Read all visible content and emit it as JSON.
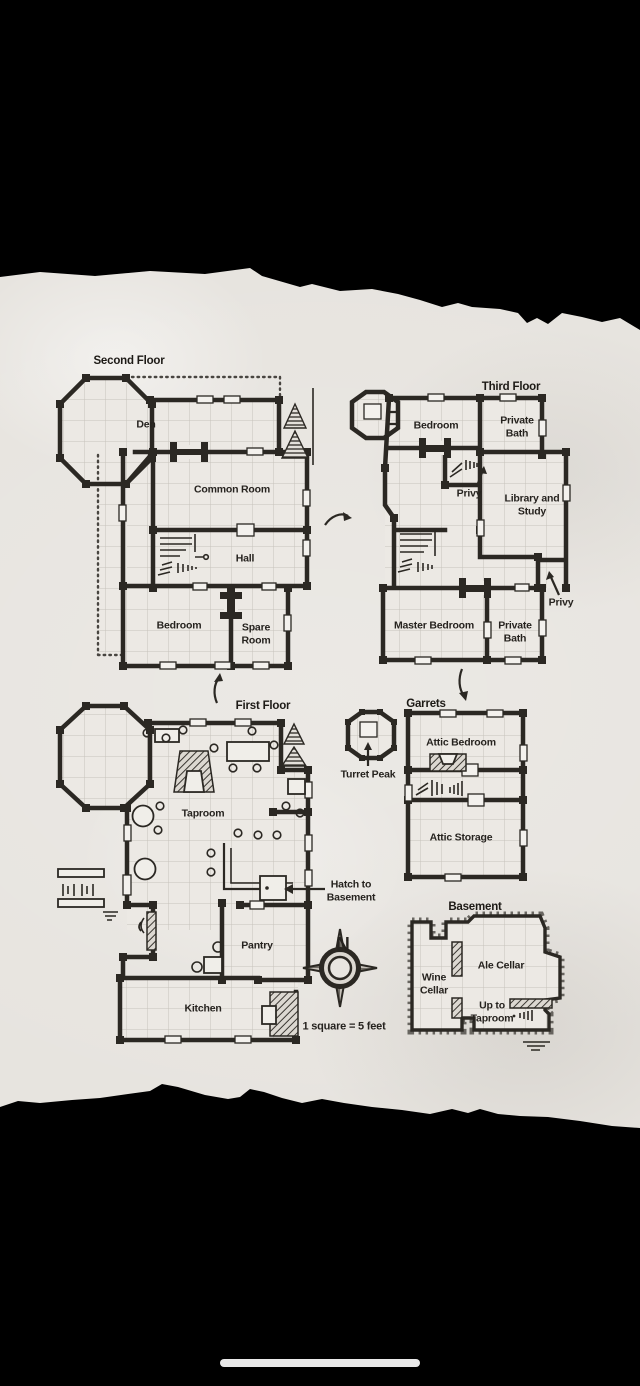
{
  "map": {
    "second_floor": {
      "title": "Second Floor",
      "rooms": {
        "den": "Den",
        "common_room": "Common Room",
        "hall": "Hall",
        "bedroom": "Bedroom",
        "spare_room": "Spare Room"
      }
    },
    "third_floor": {
      "title": "Third Floor",
      "rooms": {
        "bedroom": "Bedroom",
        "private_bath_top": "Private Bath",
        "privy_inner": "Privy",
        "library_study": "Library and Study",
        "privy_outer": "Privy",
        "master_bedroom": "Master Bedroom",
        "private_bath_bottom": "Private Bath"
      }
    },
    "first_floor": {
      "title": "First Floor",
      "rooms": {
        "taproom": "Taproom",
        "pantry": "Pantry",
        "kitchen": "Kitchen"
      },
      "hatch_note": "Hatch to Basement"
    },
    "turret_peak": {
      "label": "Turret Peak"
    },
    "garrets": {
      "title": "Garrets",
      "rooms": {
        "attic_bedroom": "Attic Bedroom",
        "attic_storage": "Attic Storage"
      }
    },
    "basement": {
      "title": "Basement",
      "rooms": {
        "wine_cellar": "Wine Cellar",
        "ale_cellar": "Ale Cellar",
        "up_to_taproom": "Up to Taproom"
      }
    },
    "compass": {
      "north_label": "N"
    },
    "scale_note": "1 square = 5 feet",
    "colors": {
      "background": "#000000",
      "paper": "#e7e4df",
      "ink": "#2b2823",
      "grid_line": "#c6c2bb"
    }
  }
}
